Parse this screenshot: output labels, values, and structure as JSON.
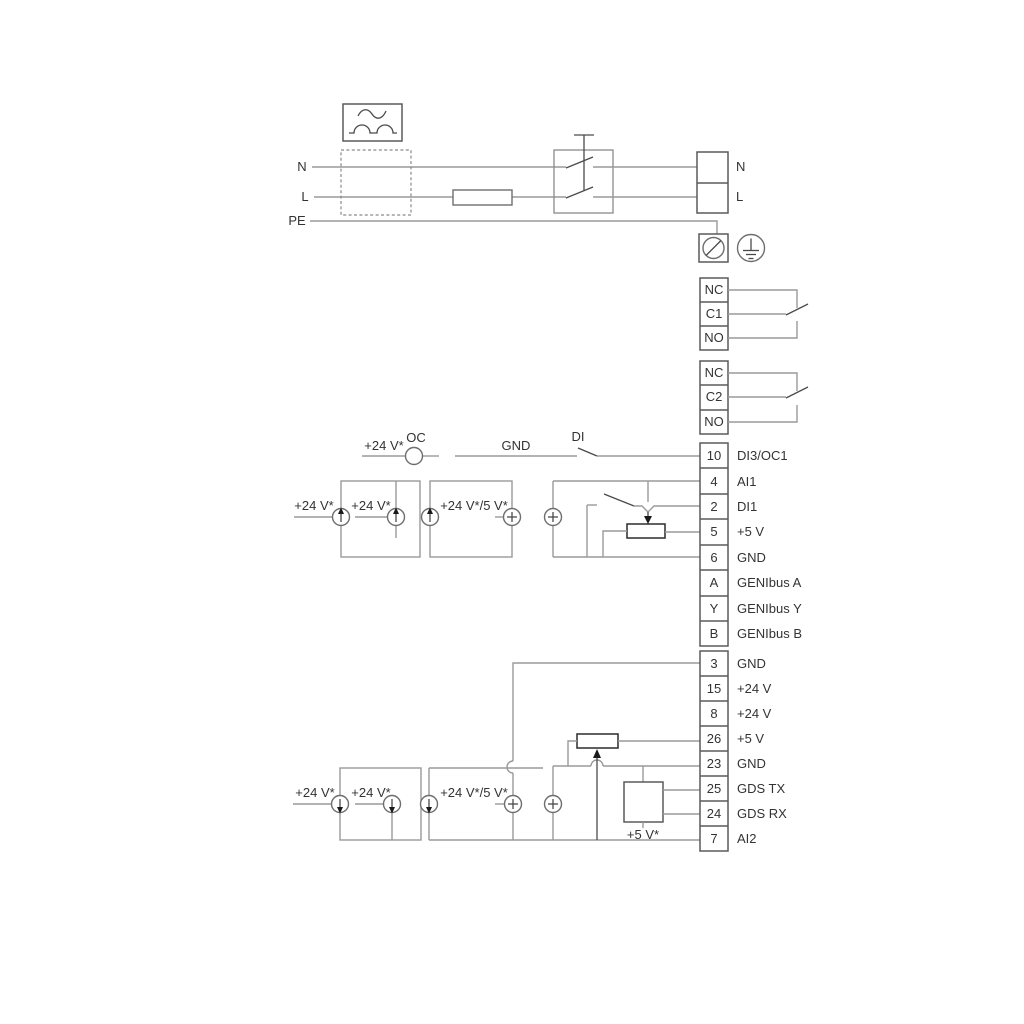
{
  "diagram": {
    "title_hint": "pump wiring diagram",
    "colors": {
      "wire": "#9a9a9a",
      "box": "#5a5a5a",
      "symbol_dark": "#2b2b2b",
      "text": "#333333"
    },
    "power": {
      "n_left": "N",
      "l_left": "L",
      "pe": "PE",
      "n_right": "N",
      "l_right": "L"
    },
    "relay1": {
      "terminals": [
        "NC",
        "C1",
        "NO"
      ]
    },
    "relay2": {
      "terminals": [
        "NC",
        "C2",
        "NO"
      ]
    },
    "strip1": {
      "terminals": [
        {
          "id": "10",
          "label": "DI3/OC1"
        },
        {
          "id": "4",
          "label": "AI1"
        },
        {
          "id": "2",
          "label": "DI1"
        },
        {
          "id": "5",
          "label": "+5 V"
        },
        {
          "id": "6",
          "label": "GND"
        },
        {
          "id": "A",
          "label": "GENIbus A"
        },
        {
          "id": "Y",
          "label": "GENIbus Y"
        },
        {
          "id": "B",
          "label": "GENIbus B"
        }
      ]
    },
    "strip2": {
      "terminals": [
        {
          "id": "3",
          "label": "GND"
        },
        {
          "id": "15",
          "label": "+24 V"
        },
        {
          "id": "8",
          "label": "+24 V"
        },
        {
          "id": "26",
          "label": "+5 V"
        },
        {
          "id": "23",
          "label": "GND"
        },
        {
          "id": "25",
          "label": "GDS TX"
        },
        {
          "id": "24",
          "label": "GDS RX"
        },
        {
          "id": "7",
          "label": "AI2"
        }
      ]
    },
    "upper_circuit": {
      "supply_oc": "+24 V*",
      "oc": "OC",
      "gnd": "GND",
      "di": "DI",
      "supply_left": "+24 V*",
      "supply_inner": "+24 V*",
      "supply_combo": "+24 V*/5 V*"
    },
    "lower_circuit": {
      "supply_left": "+24 V*",
      "supply_inner": "+24 V*",
      "supply_combo": "+24 V*/5 V*",
      "supply_5v": "+5 V*"
    }
  }
}
